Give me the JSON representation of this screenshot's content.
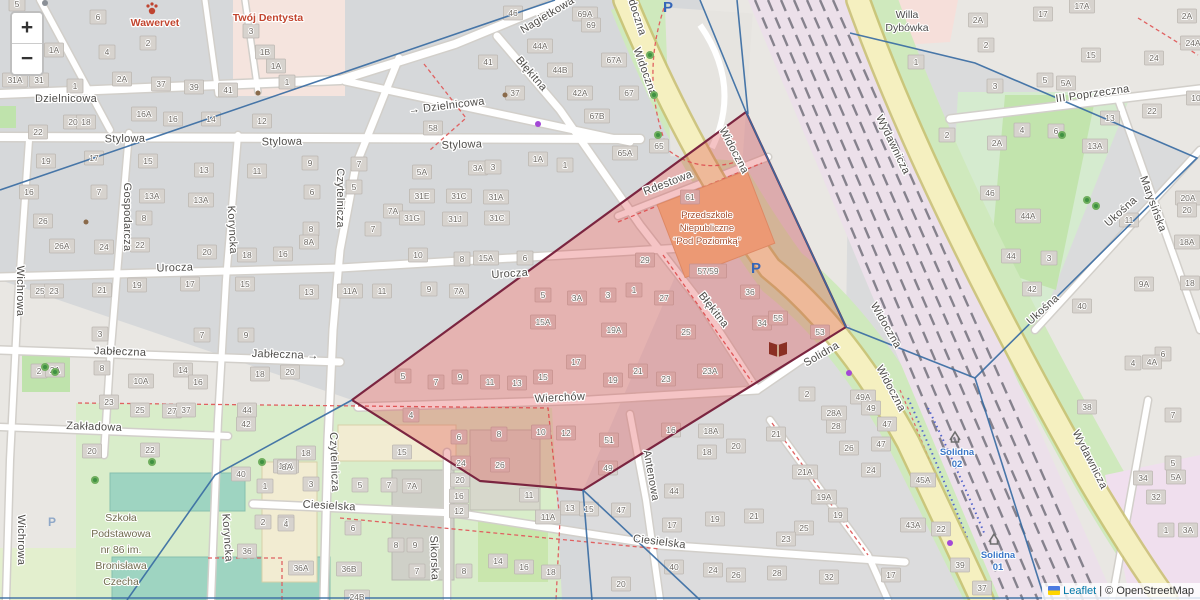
{
  "controls": {
    "zoom_in": "+",
    "zoom_out": "−"
  },
  "attribution": {
    "leaflet": "Leaflet",
    "sep": " | ",
    "osm": "© OpenStreetMap"
  },
  "colors": {
    "overlay_fill": "rgba(221,61,64,0.30)",
    "overlay_stroke": "#7b2540",
    "boundary": "#3a6da3",
    "road_yellow": "#f5f0c0",
    "rail": "#ece0ea",
    "green": "#cfe9bd",
    "accent_blue": "#3c78c8",
    "poi_red": "#c2452f"
  },
  "overlay": {
    "polygon_points": "746,112 846,327 583,490 480,481 352,400"
  },
  "boundaries": {
    "lines": [
      "555,0 0,190",
      "700,0 746,112",
      "737,0 748,114",
      "746,112 846,327",
      "846,327 975,378",
      "850,33 975,63 1197,158 975,378",
      "975,378 1045,600",
      "352,400 215,475 127,600",
      "583,490 592,600",
      "583,490 700,600",
      "0,598 1200,598"
    ]
  },
  "streets": [
    [
      "Dzielnicowa",
      66,
      102,
      0
    ],
    [
      "→ Dzielnicowa",
      447,
      109,
      -7
    ],
    [
      "Stylowa",
      125,
      142,
      -1
    ],
    [
      "Stylowa",
      282,
      145,
      -1
    ],
    [
      "Stylowa",
      462,
      148,
      -2
    ],
    [
      "Nagietkowa",
      549,
      18,
      -31
    ],
    [
      "Błękitna",
      529,
      76,
      49
    ],
    [
      "Błękitna",
      711,
      312,
      52
    ],
    [
      "Widoczna",
      632,
      12,
      72
    ],
    [
      "Widoczna",
      642,
      73,
      70
    ],
    [
      "Widoczna",
      731,
      152,
      62
    ],
    [
      "Widoczna",
      883,
      327,
      60
    ],
    [
      "Widoczna",
      888,
      390,
      62
    ],
    [
      "Rdestowa",
      669,
      186,
      -21
    ],
    [
      "Urocza",
      175,
      271,
      -2
    ],
    [
      "Urocza",
      510,
      277,
      -4
    ],
    [
      "Jabłeczna",
      120,
      355,
      2
    ],
    [
      "Jabłeczna →",
      285,
      358,
      2
    ],
    [
      "Zakładowa",
      94,
      430,
      2
    ],
    [
      "Wierchów",
      560,
      401,
      -3
    ],
    [
      "Ciesielska",
      329,
      509,
      3
    ],
    [
      "Ciesielska",
      659,
      545,
      7
    ],
    [
      "Czytelnicza",
      337,
      198,
      90
    ],
    [
      "Czytelnicza",
      331,
      462,
      88
    ],
    [
      "Gospodarcza",
      124,
      217,
      90
    ],
    [
      "Koryncka",
      229,
      230,
      87
    ],
    [
      "Koryncka",
      224,
      538,
      86
    ],
    [
      "Wichrowa",
      17,
      291,
      90
    ],
    [
      "Wichrowa",
      18,
      540,
      90
    ],
    [
      "Sikorska",
      431,
      558,
      88
    ],
    [
      "Antenowa",
      648,
      476,
      80
    ],
    [
      "Solidna",
      823,
      357,
      -30
    ],
    [
      "III Poprzeczna",
      1093,
      97,
      -8
    ],
    [
      "Wydawnicza",
      890,
      146,
      64
    ],
    [
      "Wydawnicza",
      1087,
      461,
      63
    ],
    [
      "Ukośna",
      1123,
      214,
      -42
    ],
    [
      "Ukośna",
      1045,
      312,
      -42
    ],
    [
      "Marysińska",
      1150,
      205,
      70
    ]
  ],
  "houses": [
    [
      17,
      4,
      "5"
    ],
    [
      98,
      17,
      "6"
    ],
    [
      54,
      50,
      "1A"
    ],
    [
      148,
      43,
      "2"
    ],
    [
      107,
      52,
      "4"
    ],
    [
      122,
      79,
      "2A"
    ],
    [
      15,
      80,
      "31A"
    ],
    [
      39,
      80,
      "31"
    ],
    [
      75,
      86,
      "1"
    ],
    [
      161,
      84,
      "37"
    ],
    [
      194,
      87,
      "39"
    ],
    [
      228,
      90,
      "41"
    ],
    [
      251,
      31,
      "3"
    ],
    [
      265,
      52,
      "1B"
    ],
    [
      276,
      66,
      "1A"
    ],
    [
      287,
      82,
      "1"
    ],
    [
      144,
      114,
      "16A"
    ],
    [
      73,
      122,
      "20"
    ],
    [
      86,
      122,
      "18"
    ],
    [
      173,
      119,
      "16"
    ],
    [
      211,
      119,
      "14"
    ],
    [
      262,
      121,
      "12"
    ],
    [
      38,
      132,
      "22"
    ],
    [
      46,
      161,
      "19"
    ],
    [
      94,
      158,
      "17"
    ],
    [
      148,
      161,
      "15"
    ],
    [
      204,
      170,
      "13"
    ],
    [
      257,
      171,
      "11"
    ],
    [
      29,
      192,
      "16"
    ],
    [
      99,
      192,
      "7"
    ],
    [
      152,
      196,
      "13A"
    ],
    [
      201,
      200,
      "13A"
    ],
    [
      43,
      221,
      "26"
    ],
    [
      62,
      246,
      "26A"
    ],
    [
      104,
      247,
      "24"
    ],
    [
      144,
      218,
      "8"
    ],
    [
      140,
      245,
      "22"
    ],
    [
      207,
      252,
      "20"
    ],
    [
      247,
      255,
      "18"
    ],
    [
      283,
      254,
      "16"
    ],
    [
      40,
      291,
      "25"
    ],
    [
      54,
      291,
      "23"
    ],
    [
      102,
      290,
      "21"
    ],
    [
      137,
      285,
      "19"
    ],
    [
      190,
      284,
      "17"
    ],
    [
      245,
      284,
      "15"
    ],
    [
      310,
      163,
      "9"
    ],
    [
      312,
      192,
      "6"
    ],
    [
      311,
      229,
      "8"
    ],
    [
      309,
      242,
      "8A"
    ],
    [
      309,
      292,
      "13"
    ],
    [
      359,
      164,
      "7"
    ],
    [
      354,
      187,
      "5"
    ],
    [
      422,
      172,
      "5A"
    ],
    [
      478,
      168,
      "3A"
    ],
    [
      493,
      167,
      "3"
    ],
    [
      538,
      159,
      "1A"
    ],
    [
      565,
      165,
      "1"
    ],
    [
      433,
      128,
      "58"
    ],
    [
      488,
      62,
      "41"
    ],
    [
      515,
      93,
      "37"
    ],
    [
      540,
      46,
      "44A"
    ],
    [
      560,
      70,
      "44B"
    ],
    [
      580,
      93,
      "42A"
    ],
    [
      614,
      60,
      "67A"
    ],
    [
      629,
      93,
      "67"
    ],
    [
      597,
      116,
      "67B"
    ],
    [
      625,
      153,
      "65A"
    ],
    [
      659,
      146,
      "65"
    ],
    [
      513,
      13,
      "46"
    ],
    [
      585,
      14,
      "69A"
    ],
    [
      591,
      25,
      "69"
    ],
    [
      422,
      196,
      "31E"
    ],
    [
      459,
      196,
      "31C"
    ],
    [
      496,
      197,
      "31A"
    ],
    [
      393,
      211,
      "7A"
    ],
    [
      412,
      218,
      "31G"
    ],
    [
      455,
      219,
      "31J"
    ],
    [
      497,
      218,
      "31C"
    ],
    [
      373,
      229,
      "7"
    ],
    [
      418,
      255,
      "10"
    ],
    [
      462,
      259,
      "8"
    ],
    [
      525,
      258,
      "6"
    ],
    [
      350,
      291,
      "11A"
    ],
    [
      382,
      291,
      "11"
    ],
    [
      429,
      289,
      "9"
    ],
    [
      459,
      291,
      "7A"
    ],
    [
      543,
      295,
      "5"
    ],
    [
      577,
      298,
      "3A"
    ],
    [
      608,
      295,
      "3"
    ],
    [
      634,
      290,
      "1"
    ],
    [
      664,
      298,
      "27"
    ],
    [
      486,
      258,
      "15A"
    ],
    [
      690,
      197,
      "61"
    ],
    [
      645,
      260,
      "29"
    ],
    [
      708,
      271,
      "57/59"
    ],
    [
      750,
      292,
      "36"
    ],
    [
      762,
      323,
      "34"
    ],
    [
      778,
      318,
      "55"
    ],
    [
      820,
      332,
      "53"
    ],
    [
      543,
      322,
      "15A"
    ],
    [
      614,
      330,
      "19A"
    ],
    [
      686,
      332,
      "25"
    ],
    [
      576,
      362,
      "17"
    ],
    [
      638,
      371,
      "21"
    ],
    [
      666,
      379,
      "23"
    ],
    [
      710,
      371,
      "23A"
    ],
    [
      613,
      380,
      "19"
    ],
    [
      543,
      377,
      "15"
    ],
    [
      517,
      383,
      "13"
    ],
    [
      490,
      382,
      "11"
    ],
    [
      460,
      377,
      "9"
    ],
    [
      436,
      382,
      "7"
    ],
    [
      403,
      376,
      "5"
    ],
    [
      411,
      415,
      "4"
    ],
    [
      459,
      437,
      "6"
    ],
    [
      499,
      434,
      "8"
    ],
    [
      541,
      432,
      "10"
    ],
    [
      566,
      433,
      "12"
    ],
    [
      609,
      440,
      "51"
    ],
    [
      608,
      468,
      "49"
    ],
    [
      671,
      430,
      "16"
    ],
    [
      711,
      431,
      "18A"
    ],
    [
      707,
      452,
      "18"
    ],
    [
      736,
      446,
      "20"
    ],
    [
      100,
      334,
      "3"
    ],
    [
      202,
      335,
      "7"
    ],
    [
      246,
      335,
      "9"
    ],
    [
      39,
      371,
      "2"
    ],
    [
      55,
      370,
      "2A"
    ],
    [
      102,
      368,
      "8"
    ],
    [
      141,
      381,
      "10A"
    ],
    [
      183,
      370,
      "14"
    ],
    [
      198,
      382,
      "16"
    ],
    [
      109,
      402,
      "23"
    ],
    [
      140,
      410,
      "25"
    ],
    [
      172,
      411,
      "27"
    ],
    [
      186,
      410,
      "37"
    ],
    [
      260,
      374,
      "18"
    ],
    [
      290,
      372,
      "20"
    ],
    [
      247,
      410,
      "44"
    ],
    [
      246,
      424,
      "42"
    ],
    [
      286,
      466,
      "18A"
    ],
    [
      241,
      474,
      "40"
    ],
    [
      265,
      486,
      "1"
    ],
    [
      92,
      451,
      "20"
    ],
    [
      150,
      450,
      "22"
    ],
    [
      263,
      522,
      "2"
    ],
    [
      286,
      522,
      "4"
    ],
    [
      247,
      551,
      "36"
    ],
    [
      311,
      484,
      "3"
    ],
    [
      301,
      568,
      "36A"
    ],
    [
      349,
      569,
      "36B"
    ],
    [
      357,
      597,
      "24B"
    ],
    [
      306,
      453,
      "18"
    ],
    [
      287,
      467,
      "8A"
    ],
    [
      360,
      485,
      "5"
    ],
    [
      389,
      485,
      "7"
    ],
    [
      412,
      486,
      "7A"
    ],
    [
      402,
      452,
      "15"
    ],
    [
      286,
      524,
      "4"
    ],
    [
      353,
      528,
      "6"
    ],
    [
      396,
      545,
      "8"
    ],
    [
      415,
      545,
      "9"
    ],
    [
      417,
      571,
      "7"
    ],
    [
      461,
      463,
      "24"
    ],
    [
      460,
      480,
      "20"
    ],
    [
      459,
      496,
      "16"
    ],
    [
      459,
      511,
      "12"
    ],
    [
      500,
      465,
      "26"
    ],
    [
      529,
      495,
      "11"
    ],
    [
      548,
      517,
      "11A"
    ],
    [
      570,
      508,
      "13"
    ],
    [
      589,
      509,
      "15"
    ],
    [
      621,
      510,
      "47"
    ],
    [
      498,
      561,
      "14"
    ],
    [
      524,
      567,
      "16"
    ],
    [
      551,
      572,
      "18"
    ],
    [
      621,
      584,
      "20"
    ],
    [
      464,
      571,
      "8"
    ],
    [
      776,
      434,
      "21"
    ],
    [
      836,
      426,
      "28"
    ],
    [
      834,
      413,
      "28A"
    ],
    [
      849,
      448,
      "26"
    ],
    [
      887,
      424,
      "47"
    ],
    [
      881,
      444,
      "47"
    ],
    [
      871,
      470,
      "24"
    ],
    [
      674,
      491,
      "44"
    ],
    [
      805,
      472,
      "21A"
    ],
    [
      824,
      497,
      "19A"
    ],
    [
      838,
      515,
      "19"
    ],
    [
      754,
      516,
      "21"
    ],
    [
      715,
      519,
      "19"
    ],
    [
      672,
      525,
      "17"
    ],
    [
      804,
      528,
      "25"
    ],
    [
      786,
      539,
      "23"
    ],
    [
      674,
      567,
      "40"
    ],
    [
      713,
      570,
      "24"
    ],
    [
      736,
      575,
      "26"
    ],
    [
      777,
      573,
      "28"
    ],
    [
      829,
      577,
      "32"
    ],
    [
      891,
      575,
      "17"
    ],
    [
      807,
      394,
      "2"
    ],
    [
      863,
      397,
      "49A"
    ],
    [
      871,
      408,
      "49"
    ],
    [
      978,
      20,
      "2A"
    ],
    [
      986,
      45,
      "2"
    ],
    [
      1043,
      14,
      "17"
    ],
    [
      1082,
      6,
      "17A"
    ],
    [
      1091,
      55,
      "15"
    ],
    [
      1045,
      80,
      "5"
    ],
    [
      1066,
      83,
      "5A"
    ],
    [
      995,
      86,
      "3"
    ],
    [
      1154,
      58,
      "24"
    ],
    [
      1193,
      43,
      "24A"
    ],
    [
      1196,
      98,
      "10"
    ],
    [
      1152,
      111,
      "22"
    ],
    [
      1110,
      118,
      "13"
    ],
    [
      1095,
      146,
      "13A"
    ],
    [
      997,
      143,
      "2A"
    ],
    [
      1022,
      130,
      "4"
    ],
    [
      1056,
      131,
      "6"
    ],
    [
      947,
      135,
      "2"
    ],
    [
      916,
      62,
      "1"
    ],
    [
      1187,
      16,
      "2A"
    ],
    [
      990,
      193,
      "46"
    ],
    [
      1028,
      216,
      "44A"
    ],
    [
      1011,
      256,
      "44"
    ],
    [
      1049,
      258,
      "3"
    ],
    [
      1032,
      289,
      "42"
    ],
    [
      1129,
      220,
      "11"
    ],
    [
      1144,
      284,
      "9A"
    ],
    [
      1082,
      306,
      "40"
    ],
    [
      1188,
      198,
      "20A"
    ],
    [
      1187,
      210,
      "20"
    ],
    [
      1187,
      242,
      "18A"
    ],
    [
      1190,
      283,
      "18"
    ],
    [
      1163,
      354,
      "6"
    ],
    [
      1133,
      363,
      "4"
    ],
    [
      1152,
      362,
      "4A"
    ],
    [
      1087,
      407,
      "38"
    ],
    [
      1173,
      415,
      "7"
    ],
    [
      1143,
      478,
      "34"
    ],
    [
      1173,
      463,
      "5"
    ],
    [
      1176,
      477,
      "5A"
    ],
    [
      1156,
      497,
      "32"
    ],
    [
      1166,
      530,
      "1"
    ],
    [
      1188,
      530,
      "3A"
    ],
    [
      923,
      480,
      "45A"
    ],
    [
      913,
      525,
      "43A"
    ],
    [
      941,
      529,
      "22"
    ],
    [
      960,
      565,
      "39"
    ],
    [
      982,
      588,
      "37"
    ]
  ],
  "pois": [
    {
      "name": "vet",
      "cls": "poi-red",
      "x": 155,
      "y": 26,
      "dy": 12,
      "lines": [
        "Wawervet"
      ]
    },
    {
      "name": "dentist",
      "cls": "poi-red",
      "x": 268,
      "y": 21,
      "dy": 12,
      "lines": [
        "Twój Dentysta"
      ]
    },
    {
      "name": "villa",
      "cls": "poi-gray",
      "x": 907,
      "y": 18,
      "dy": 13,
      "lines": [
        "Willa",
        "Dybówka"
      ]
    },
    {
      "name": "kindergarten",
      "cls": "poi-maroon",
      "x": 707,
      "y": 218,
      "dy": 13,
      "lines": [
        "Przedszkole",
        "Niepubliczne",
        "“Pod Poziomką”"
      ]
    },
    {
      "name": "school",
      "cls": "poi-school",
      "x": 121,
      "y": 521,
      "dy": 16,
      "lines": [
        "Szkoła",
        "Podstawowa",
        "nr 86 im.",
        "Bronisława",
        "Czecha"
      ]
    },
    {
      "name": "stop-solidna-02",
      "cls": "transit",
      "x": 957,
      "y": 455,
      "dy": 12,
      "lines": [
        "Solidna",
        "02"
      ]
    },
    {
      "name": "stop-solidna-01",
      "cls": "transit",
      "x": 998,
      "y": 558,
      "dy": 12,
      "lines": [
        "Solidna",
        "01"
      ]
    }
  ],
  "icons": {
    "parking_big": [
      [
        668,
        12
      ],
      [
        756,
        273
      ]
    ],
    "parking_small": [
      [
        52,
        526
      ]
    ],
    "shelters": [
      [
        955,
        436
      ],
      [
        994,
        538
      ]
    ],
    "paw": [
      152,
      8
    ],
    "book": [
      778,
      348
    ],
    "dots_purple": [
      [
        538,
        124
      ],
      [
        849,
        373
      ],
      [
        950,
        543
      ]
    ],
    "dots_brown": [
      [
        505,
        95
      ],
      [
        86,
        222
      ],
      [
        258,
        93
      ]
    ],
    "dots_gray": [
      [
        45,
        3
      ]
    ],
    "trees": [
      [
        650,
        55
      ],
      [
        654,
        95
      ],
      [
        658,
        135
      ],
      [
        1087,
        200
      ],
      [
        1096,
        206
      ],
      [
        45,
        367
      ],
      [
        55,
        372
      ],
      [
        152,
        462
      ],
      [
        262,
        462
      ],
      [
        95,
        480
      ],
      [
        1062,
        135
      ]
    ]
  }
}
